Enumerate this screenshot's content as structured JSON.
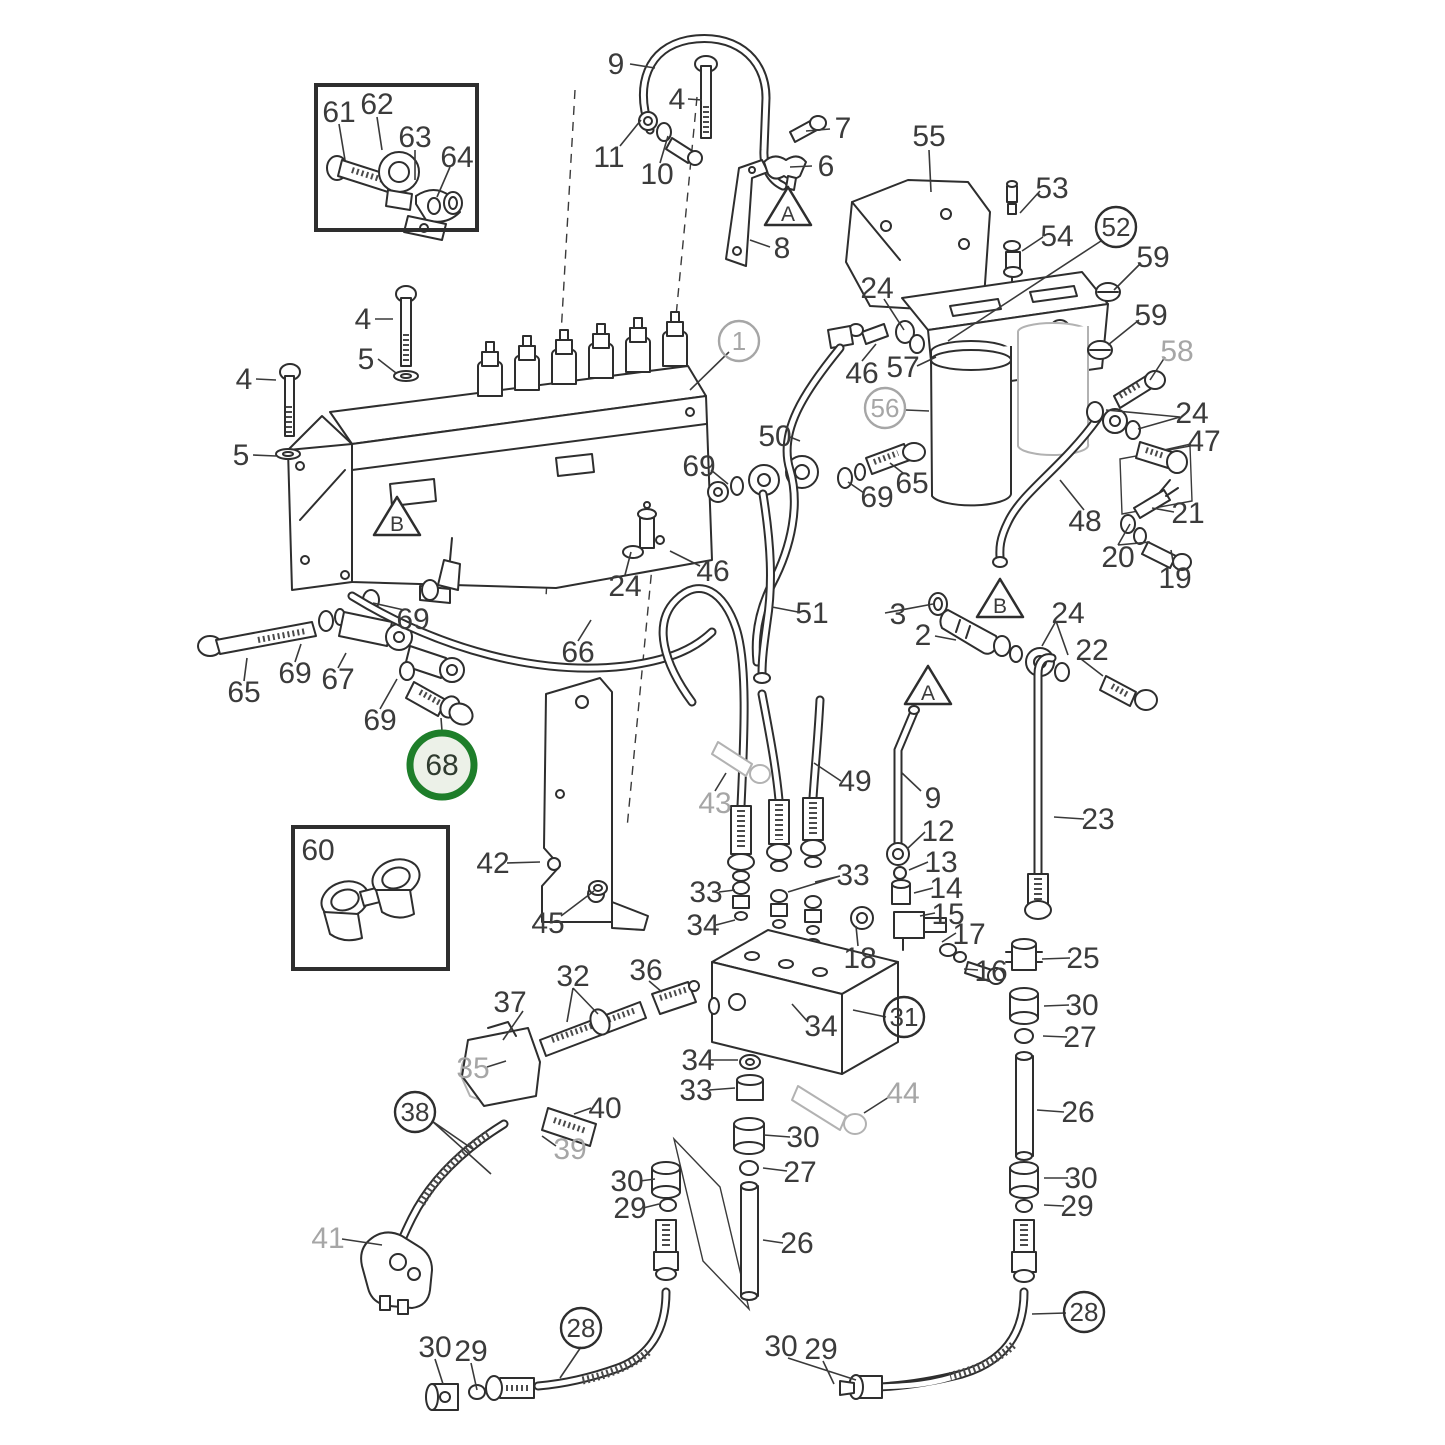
{
  "diagram": {
    "highlighted_part": "68",
    "colors": {
      "line": "#2e2e2e",
      "label": "#3b3b3b",
      "muted_label": "#a6a6a6",
      "circle_dark": "#2e2e2e",
      "circle_gray": "#a6a6a6",
      "highlight_ring": "#1e7e2a",
      "highlight_fill": "#ecf1e8",
      "background": "#ffffff"
    },
    "insets": [
      {
        "name": "inset-parts-61-64",
        "x": 316,
        "y": 85,
        "w": 161,
        "h": 145
      },
      {
        "name": "inset-part-60",
        "x": 293,
        "y": 827,
        "w": 155,
        "h": 142
      }
    ],
    "markers": [
      {
        "letter": "A",
        "x": 788,
        "y": 208
      },
      {
        "letter": "B",
        "x": 397,
        "y": 518
      },
      {
        "letter": "B",
        "x": 1000,
        "y": 600
      },
      {
        "letter": "A",
        "x": 928,
        "y": 687
      }
    ],
    "labels": [
      {
        "t": "61",
        "x": 339,
        "y": 112
      },
      {
        "t": "62",
        "x": 377,
        "y": 104
      },
      {
        "t": "63",
        "x": 415,
        "y": 137
      },
      {
        "t": "64",
        "x": 457,
        "y": 157
      },
      {
        "t": "9",
        "x": 616,
        "y": 64
      },
      {
        "t": "4",
        "x": 677,
        "y": 99
      },
      {
        "t": "7",
        "x": 843,
        "y": 128
      },
      {
        "t": "6",
        "x": 826,
        "y": 166
      },
      {
        "t": "11",
        "x": 609,
        "y": 157
      },
      {
        "t": "10",
        "x": 657,
        "y": 174
      },
      {
        "t": "8",
        "x": 782,
        "y": 248
      },
      {
        "t": "55",
        "x": 929,
        "y": 136
      },
      {
        "t": "53",
        "x": 1052,
        "y": 188
      },
      {
        "t": "54",
        "x": 1057,
        "y": 236
      },
      {
        "t": "52",
        "x": 1116,
        "y": 227,
        "circle": "dark"
      },
      {
        "t": "59",
        "x": 1153,
        "y": 257
      },
      {
        "t": "59",
        "x": 1151,
        "y": 315
      },
      {
        "t": "58",
        "x": 1177,
        "y": 351,
        "muted": true
      },
      {
        "t": "24",
        "x": 877,
        "y": 288
      },
      {
        "t": "46",
        "x": 862,
        "y": 373
      },
      {
        "t": "57",
        "x": 903,
        "y": 367
      },
      {
        "t": "56",
        "x": 885,
        "y": 408,
        "muted": true,
        "circle": "gray"
      },
      {
        "t": "24",
        "x": 1192,
        "y": 413
      },
      {
        "t": "47",
        "x": 1204,
        "y": 441
      },
      {
        "t": "21",
        "x": 1188,
        "y": 513
      },
      {
        "t": "20",
        "x": 1118,
        "y": 557
      },
      {
        "t": "19",
        "x": 1175,
        "y": 578
      },
      {
        "t": "48",
        "x": 1085,
        "y": 521
      },
      {
        "t": "4",
        "x": 363,
        "y": 319
      },
      {
        "t": "5",
        "x": 366,
        "y": 359
      },
      {
        "t": "4",
        "x": 244,
        "y": 379
      },
      {
        "t": "5",
        "x": 241,
        "y": 455
      },
      {
        "t": "1",
        "x": 739,
        "y": 341,
        "muted": true,
        "circle": "gray"
      },
      {
        "t": "69",
        "x": 413,
        "y": 619
      },
      {
        "t": "24",
        "x": 625,
        "y": 586
      },
      {
        "t": "46",
        "x": 713,
        "y": 571
      },
      {
        "t": "66",
        "x": 578,
        "y": 652
      },
      {
        "t": "65",
        "x": 244,
        "y": 692
      },
      {
        "t": "69",
        "x": 295,
        "y": 673
      },
      {
        "t": "67",
        "x": 338,
        "y": 679
      },
      {
        "t": "69",
        "x": 380,
        "y": 720
      },
      {
        "t": "68",
        "x": 442,
        "y": 765,
        "circle": "green"
      },
      {
        "t": "50",
        "x": 775,
        "y": 436
      },
      {
        "t": "69",
        "x": 699,
        "y": 466
      },
      {
        "t": "69",
        "x": 877,
        "y": 497
      },
      {
        "t": "65",
        "x": 912,
        "y": 483
      },
      {
        "t": "51",
        "x": 812,
        "y": 613
      },
      {
        "t": "3",
        "x": 898,
        "y": 614
      },
      {
        "t": "2",
        "x": 923,
        "y": 635
      },
      {
        "t": "24",
        "x": 1068,
        "y": 613
      },
      {
        "t": "22",
        "x": 1092,
        "y": 650
      },
      {
        "t": "9",
        "x": 933,
        "y": 798
      },
      {
        "t": "23",
        "x": 1098,
        "y": 819
      },
      {
        "t": "49",
        "x": 855,
        "y": 781
      },
      {
        "t": "43",
        "x": 715,
        "y": 803,
        "muted": true
      },
      {
        "t": "42",
        "x": 493,
        "y": 863
      },
      {
        "t": "45",
        "x": 548,
        "y": 923
      },
      {
        "t": "33",
        "x": 706,
        "y": 892
      },
      {
        "t": "33",
        "x": 853,
        "y": 875
      },
      {
        "t": "34",
        "x": 703,
        "y": 925
      },
      {
        "t": "12",
        "x": 938,
        "y": 831
      },
      {
        "t": "13",
        "x": 941,
        "y": 862
      },
      {
        "t": "14",
        "x": 946,
        "y": 888
      },
      {
        "t": "15",
        "x": 948,
        "y": 914
      },
      {
        "t": "17",
        "x": 969,
        "y": 934
      },
      {
        "t": "16",
        "x": 991,
        "y": 971
      },
      {
        "t": "18",
        "x": 860,
        "y": 958
      },
      {
        "t": "36",
        "x": 646,
        "y": 970
      },
      {
        "t": "32",
        "x": 573,
        "y": 976
      },
      {
        "t": "31",
        "x": 904,
        "y": 1017,
        "circle": "dark"
      },
      {
        "t": "34",
        "x": 821,
        "y": 1026
      },
      {
        "t": "34",
        "x": 698,
        "y": 1060
      },
      {
        "t": "33",
        "x": 696,
        "y": 1090
      },
      {
        "t": "44",
        "x": 903,
        "y": 1093,
        "muted": true
      },
      {
        "t": "25",
        "x": 1083,
        "y": 958
      },
      {
        "t": "30",
        "x": 1082,
        "y": 1005
      },
      {
        "t": "27",
        "x": 1080,
        "y": 1037
      },
      {
        "t": "26",
        "x": 1078,
        "y": 1112
      },
      {
        "t": "30",
        "x": 1081,
        "y": 1178
      },
      {
        "t": "29",
        "x": 1077,
        "y": 1206
      },
      {
        "t": "28",
        "x": 1084,
        "y": 1312,
        "circle": "dark"
      },
      {
        "t": "60",
        "x": 318,
        "y": 850
      },
      {
        "t": "37",
        "x": 510,
        "y": 1002
      },
      {
        "t": "35",
        "x": 473,
        "y": 1068,
        "muted": true
      },
      {
        "t": "38",
        "x": 415,
        "y": 1112,
        "circle": "dark"
      },
      {
        "t": "40",
        "x": 605,
        "y": 1108
      },
      {
        "t": "39",
        "x": 570,
        "y": 1149,
        "muted": true
      },
      {
        "t": "41",
        "x": 328,
        "y": 1238,
        "muted": true
      },
      {
        "t": "30",
        "x": 627,
        "y": 1181
      },
      {
        "t": "29",
        "x": 630,
        "y": 1208
      },
      {
        "t": "28",
        "x": 581,
        "y": 1328,
        "circle": "dark"
      },
      {
        "t": "30",
        "x": 435,
        "y": 1347
      },
      {
        "t": "29",
        "x": 471,
        "y": 1351
      },
      {
        "t": "30",
        "x": 803,
        "y": 1137
      },
      {
        "t": "27",
        "x": 800,
        "y": 1172
      },
      {
        "t": "26",
        "x": 797,
        "y": 1243
      },
      {
        "t": "30",
        "x": 781,
        "y": 1346
      },
      {
        "t": "29",
        "x": 821,
        "y": 1349
      }
    ]
  }
}
